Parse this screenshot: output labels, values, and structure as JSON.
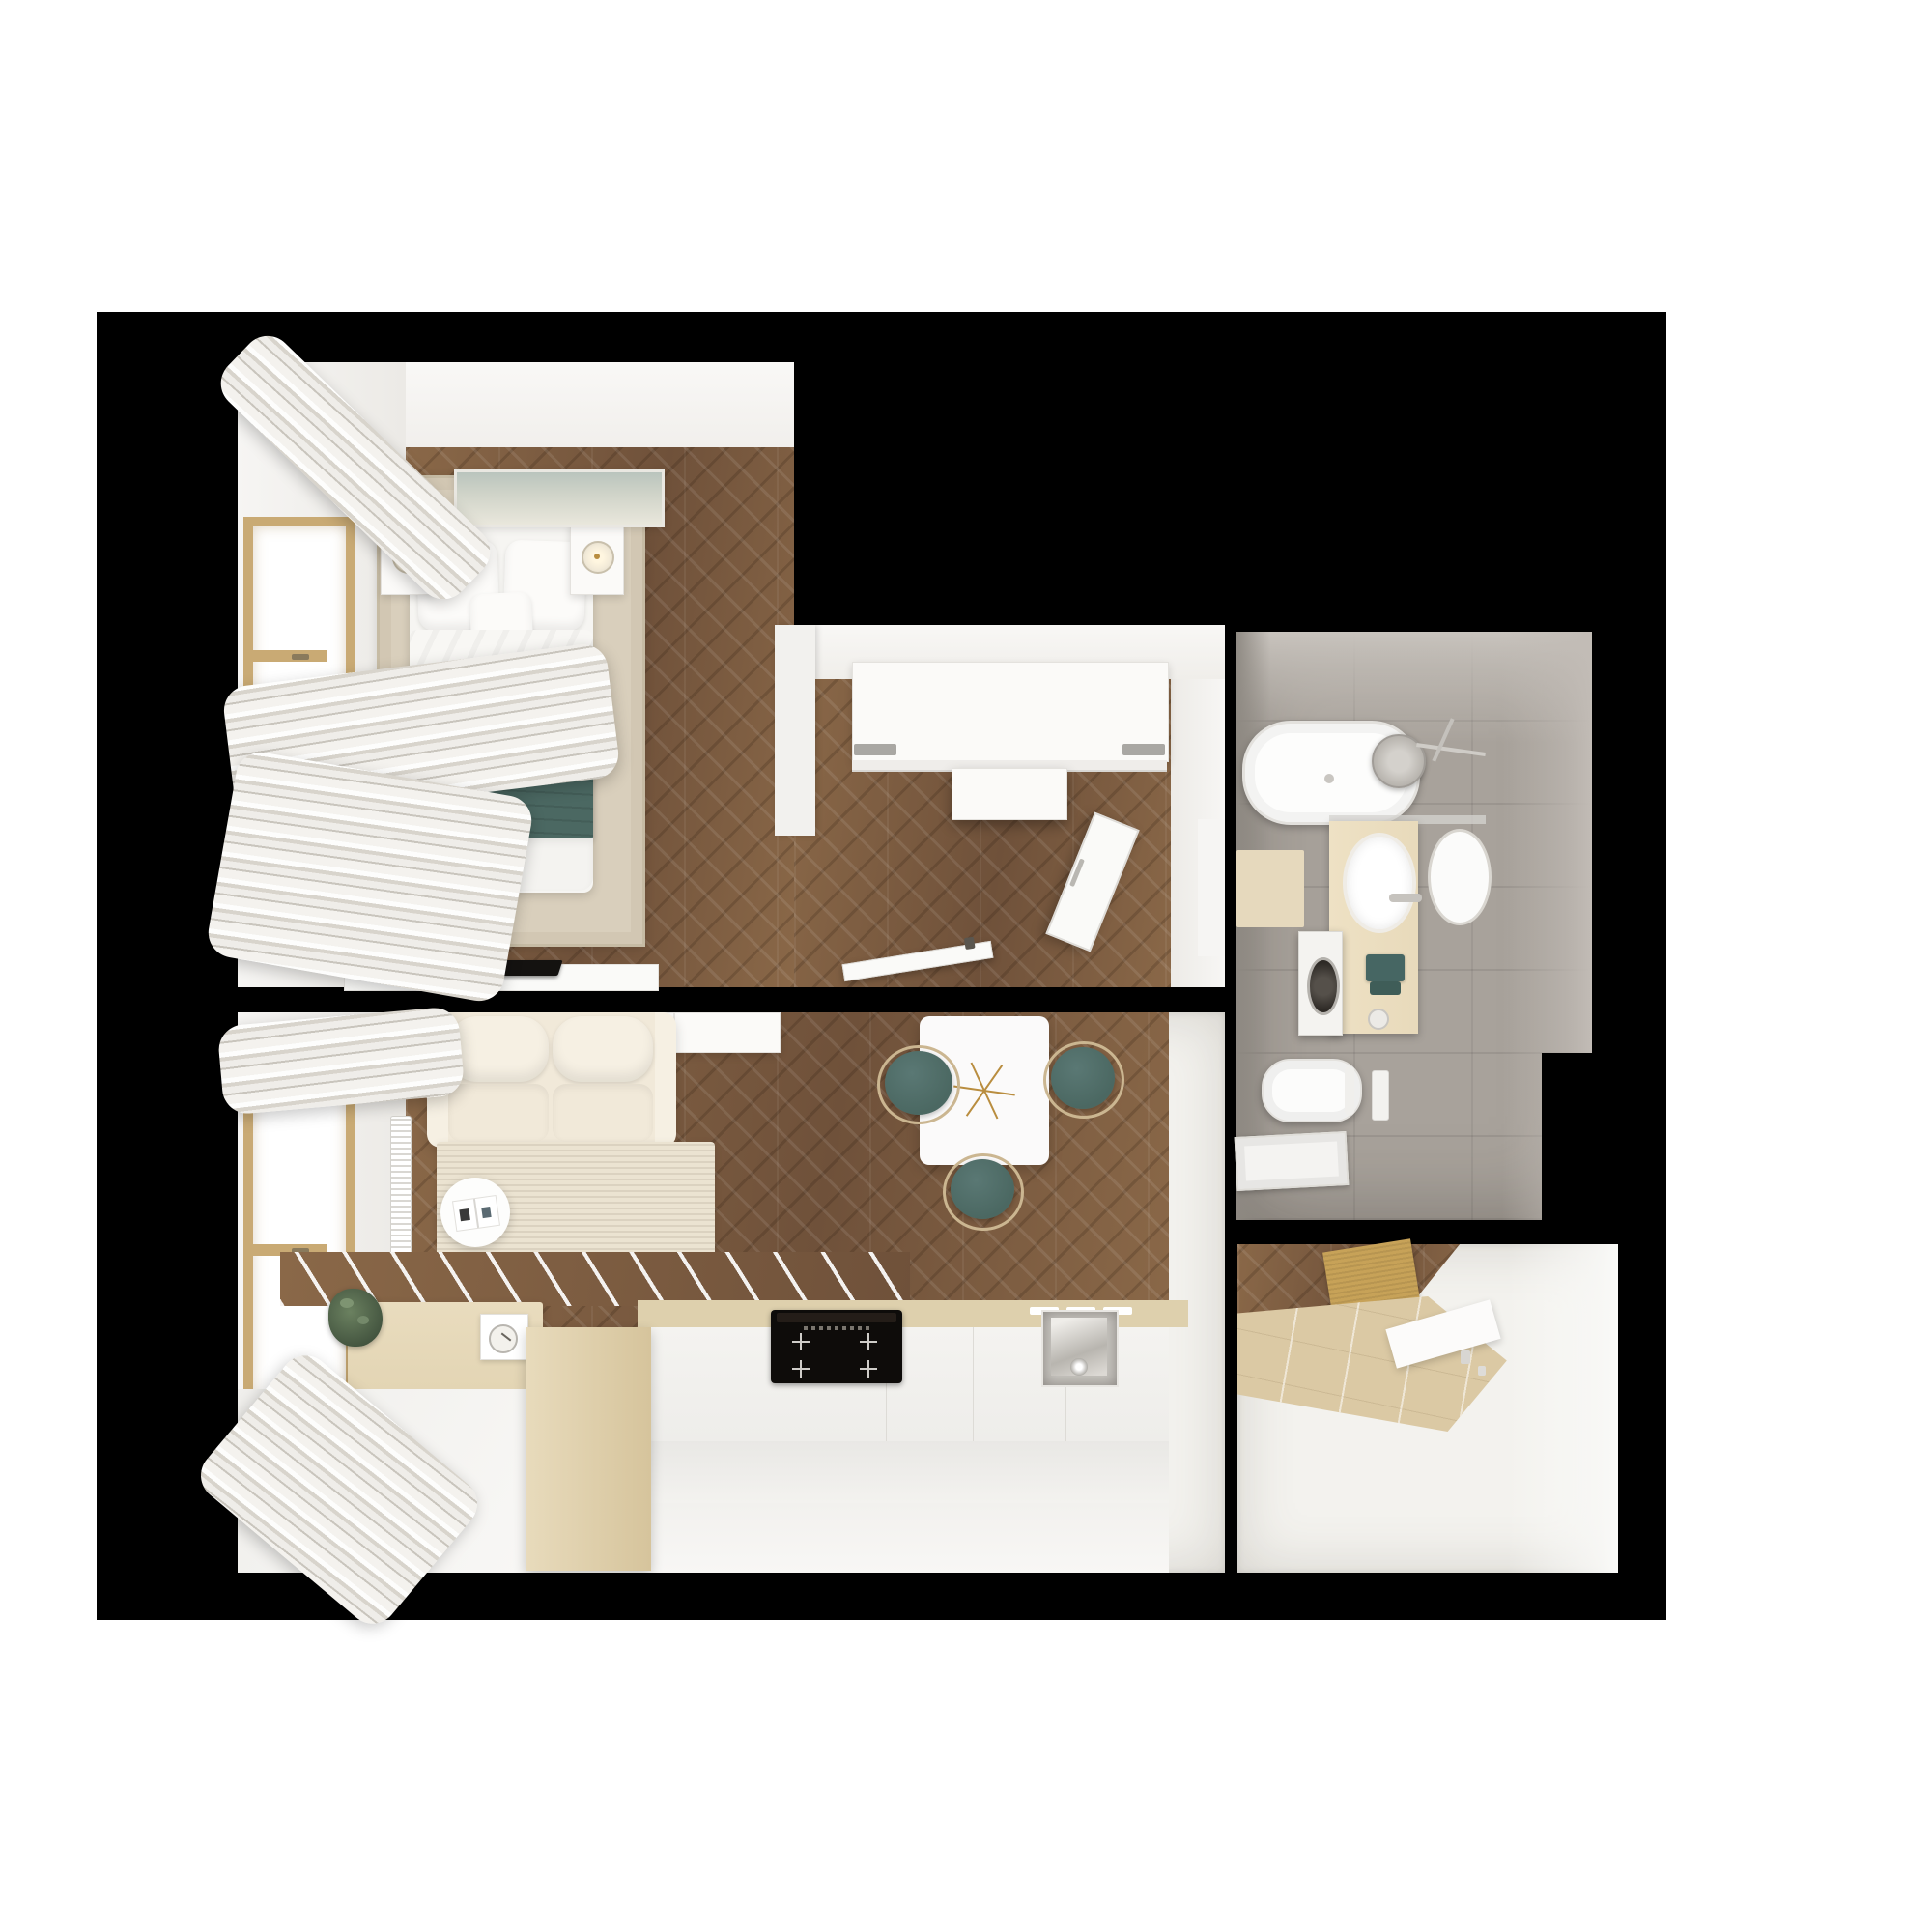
{
  "scene": {
    "type": "apartment-floor-plan-3d-top-down-render",
    "text_content": "none — image contains no visible text or UI labels",
    "backdrop_color": "#000000",
    "page_background": "#ffffff"
  },
  "palette": {
    "backdrop": "#000000",
    "wall": "#f3f2ee",
    "wall-bright": "#f8f7f5",
    "wood": "#7d5c41",
    "wood-hi": "#8a6848",
    "wood-lo": "#6f513a",
    "rug-bed": "#d9cfbc",
    "rug-bed-line": "#c6bba4",
    "rug-liv": "#ebe3d1",
    "bedding": "#f6f5f2",
    "teal": "#4b6862",
    "teal-dark": "#3f5d58",
    "headboard": "#e9dcc4",
    "cream": "#f1e9d9",
    "cream-hi": "#f6f0e3",
    "beige-cab": "#e3d5b4",
    "beige-counter": "#ded0ad",
    "frame-tan": "#c9aa74",
    "curt-a": "#fdfdfc",
    "curt-b": "#d8d4cc",
    "curt-c": "#efede9",
    "tile-grey": "#a8a29b",
    "tile-wall": "#c9c4be",
    "vanity": "#e8dabb",
    "mat": "#c7a258",
    "tile-entry": "#dbc9a4",
    "tv": "#141210",
    "glass1": "#2a211b",
    "glass2": "#5a4433",
    "chair-frame": "#cbb691",
    "gold": "#b98d3f",
    "steel": "#c6c3be"
  },
  "rooms": [
    {
      "id": "bedroom",
      "name": "bedroom",
      "furniture": [
        "double-bed",
        "headboard",
        "pillows",
        "teal-blanket",
        "area-rug",
        "nightstand-left",
        "nightstand-right",
        "sconce-lamp-left",
        "sconce-lamp-right",
        "seascape-artwork",
        "window",
        "curtains",
        "radiator",
        "tv-console",
        "flat-tv"
      ]
    },
    {
      "id": "hallway",
      "name": "hallway",
      "furniture": [
        "sliding-door-wardrobe",
        "open-wardrobe-panel",
        "entrance-door-open",
        "interior-door-leaf"
      ]
    },
    {
      "id": "living-kitchen",
      "name": "living room + kitchen",
      "furniture": [
        "cream-sofa",
        "textured-rug",
        "round-side-table",
        "open-book",
        "sideboard",
        "window",
        "curtains",
        "radiator",
        "tv-cabinet",
        "potted-plant",
        "clock-book-decor",
        "flat-tv-panel",
        "kitchen-counter",
        "induction-cooktop",
        "kitchen-sink",
        "backsplash",
        "island-cabinet",
        "dining-table",
        "brass-starburst-decor",
        "dining-chair-left",
        "dining-chair-right",
        "dining-chair-bottom"
      ]
    },
    {
      "id": "bathroom",
      "name": "bathroom",
      "furniture": [
        "bathtub",
        "shower-head",
        "glass-shelf",
        "vanity-counter",
        "basin",
        "mirrored-basin",
        "faucet",
        "washing-machine",
        "teal-towels",
        "soap-dispenser",
        "wall-hung-toilet",
        "flush-plate",
        "shower-tray",
        "bath-mat"
      ]
    },
    {
      "id": "entry",
      "name": "entry vestibule",
      "furniture": [
        "doormat",
        "beige-floor-tiles",
        "threshold-step",
        "wall-outlets"
      ]
    }
  ]
}
